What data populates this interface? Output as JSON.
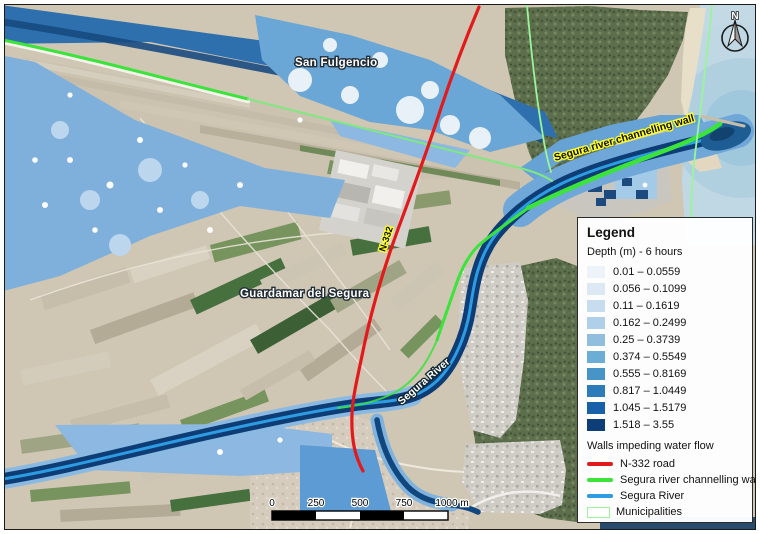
{
  "map": {
    "labels": {
      "san_fulgencio": "San Fulgencio",
      "guardamar": "Guardamar del Segura",
      "n332": "N-332",
      "channelling_wall": "Segura river channelling wall",
      "segura_river": "Segura River"
    },
    "colors": {
      "road_red": "#e31a1c",
      "wall_green": "#3be33b",
      "river_blue": "#2d9ce3",
      "municipality_green": "#9af49a",
      "channel_navy": "#0e3c74",
      "flood_medium": "#6aa6d6",
      "sea": "#c3dae5"
    }
  },
  "north_arrow": {
    "label": "N"
  },
  "scalebar": {
    "ticks": [
      "0",
      "250",
      "500",
      "750",
      "1000 m"
    ]
  },
  "legend": {
    "title": "Legend",
    "depth_heading": "Depth (m) - 6 hours",
    "depth_classes": [
      {
        "label": "0.01 – 0.0559",
        "color": "#eef3fa"
      },
      {
        "label": "0.056 – 0.1099",
        "color": "#dce8f4"
      },
      {
        "label": "0.11 – 0.1619",
        "color": "#c8dcef"
      },
      {
        "label": "0.162 – 0.2499",
        "color": "#b0cfe8"
      },
      {
        "label": "0.25 – 0.3739",
        "color": "#92bede"
      },
      {
        "label": "0.374 – 0.5549",
        "color": "#6badd4"
      },
      {
        "label": "0.555 – 0.8169",
        "color": "#4795c8"
      },
      {
        "label": "0.817 – 1.0449",
        "color": "#2c7cba"
      },
      {
        "label": "1.045 – 1.5179",
        "color": "#1661a8"
      },
      {
        "label": "1.518 – 3.55",
        "color": "#0d3e78"
      }
    ],
    "walls_heading": "Walls impeding water flow",
    "line_items": [
      {
        "label": "N-332 road",
        "color": "#e31a1c"
      },
      {
        "label": "Segura river channelling wall",
        "color": "#3be33b"
      },
      {
        "label": "Segura River",
        "color": "#2d9ce3"
      }
    ],
    "municipalities": {
      "label": "Municipalities",
      "color": "#9af49a"
    }
  }
}
